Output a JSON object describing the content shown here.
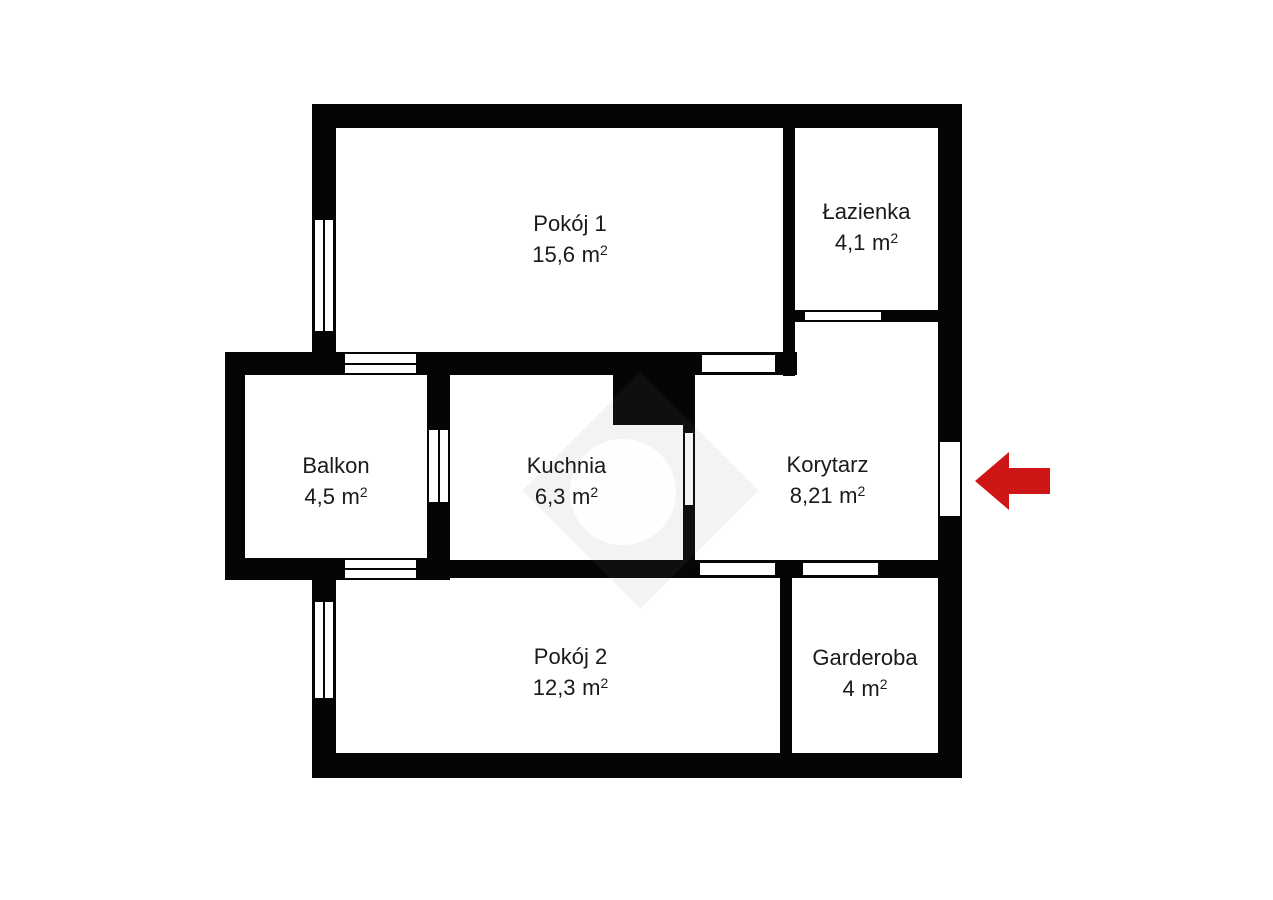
{
  "page": {
    "background_color": "#ffffff"
  },
  "floorplan": {
    "unit": "m",
    "unit_exponent": "2",
    "wall_color": "#050505",
    "entrance_arrow_color": "#ce1616",
    "rooms": [
      {
        "name": "Pokój 1",
        "area": "15,6"
      },
      {
        "name": "Łazienka",
        "area": "4,1"
      },
      {
        "name": "Balkon",
        "area": "4,5"
      },
      {
        "name": "Kuchnia",
        "area": "6,3"
      },
      {
        "name": "Korytarz",
        "area": "8,21"
      },
      {
        "name": "Pokój 2",
        "area": "12,3"
      },
      {
        "name": "Garderoba",
        "area": "4"
      }
    ]
  }
}
